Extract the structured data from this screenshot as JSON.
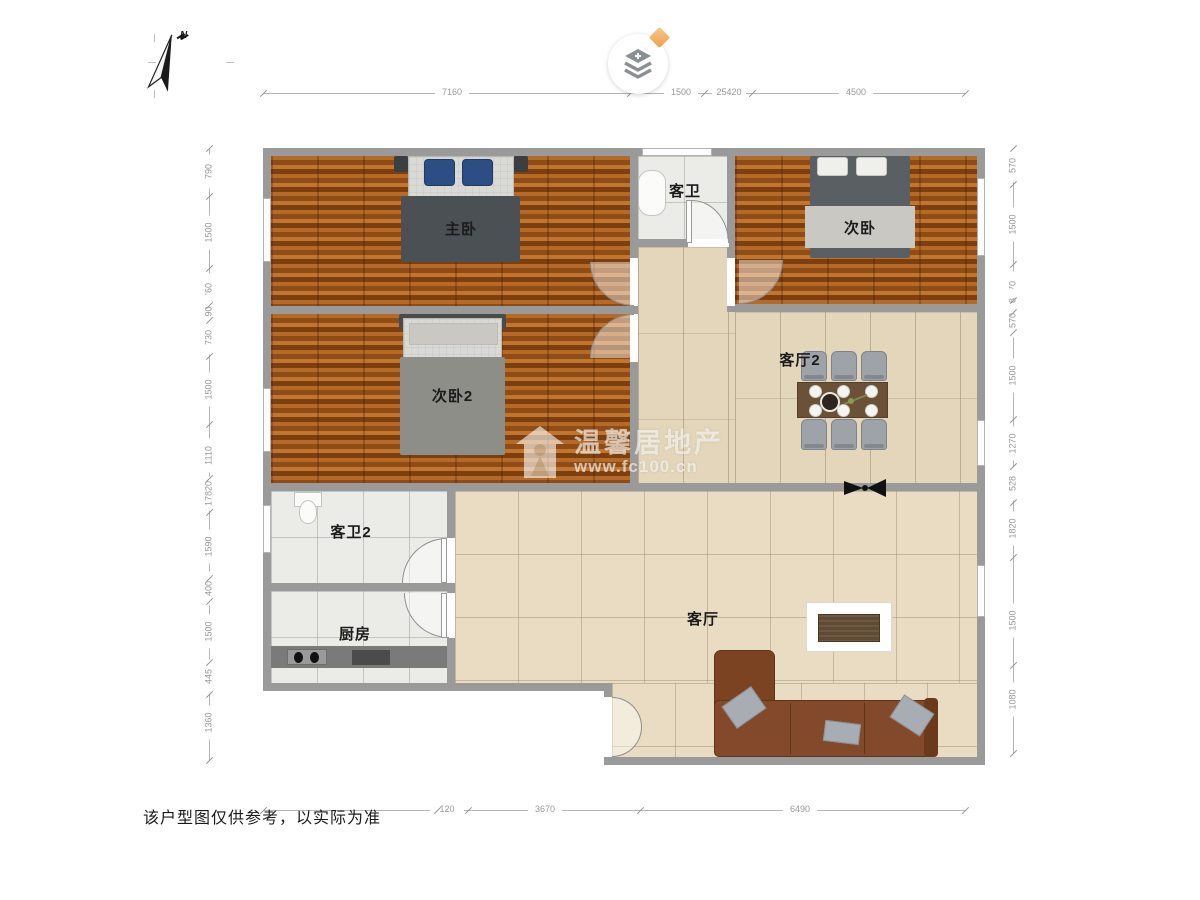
{
  "page": {
    "disclaimer": "该户型图仅供参考，以实际为准"
  },
  "watermark": {
    "brand": "温馨居地产",
    "url": "www.fc100.cn",
    "icon": "house-person-icon"
  },
  "compass": {
    "label": "N",
    "icon": "north-arrow-icon"
  },
  "logo": {
    "icon": "layers-plus-icon",
    "badge_icon": "diamond-icon",
    "badge_color": "#eda04b"
  },
  "colors": {
    "wall": "#9a9a9a",
    "wood_floor": "#9c5517",
    "tile_dining": "#e3d6ba",
    "tile_living": "#e9dcc2",
    "tile_bath": "#ebebe8",
    "sofa": "#7c4322",
    "dining_table": "#6a5138",
    "pillow_blue": "#2d4d85",
    "blanket_dark": "#4b5055"
  },
  "rooms": [
    {
      "id": "master-bedroom",
      "label": "主卧"
    },
    {
      "id": "bedroom2",
      "label": "次卧2"
    },
    {
      "id": "bedroom",
      "label": "次卧"
    },
    {
      "id": "bathroom",
      "label": "客卫"
    },
    {
      "id": "dining-hall",
      "label": "客厅2"
    },
    {
      "id": "bathroom2",
      "label": "客卫2"
    },
    {
      "id": "kitchen",
      "label": "厨房"
    },
    {
      "id": "living-room",
      "label": "客厅"
    }
  ],
  "furniture": {
    "master_bed": "double-bed-icon",
    "bedroom2_bed": "double-bed-icon",
    "bedroom_bed": "double-bed-icon",
    "dining_table": "dining-table-icon",
    "dining_chairs": "chair-icon",
    "sofa": "sectional-sofa-icon",
    "tv_cabinet": "tv-cabinet-icon",
    "bathtub": "bathtub-icon",
    "toilet": "toilet-icon",
    "kitchen_counter": "kitchen-counter-icon",
    "sink": "double-sink-icon",
    "vent": "ceiling-fan-icon"
  },
  "dimensions": {
    "top": {
      "labels": [
        {
          "t": "7160",
          "p": 452
        },
        {
          "t": "1500",
          "p": 681
        },
        {
          "t": "25420",
          "p": 729
        },
        {
          "t": "4500",
          "p": 856
        }
      ],
      "ticks": [
        263,
        630,
        704,
        752,
        965
      ]
    },
    "bottom": {
      "labels": [
        {
          "t": "120",
          "p": 447
        },
        {
          "t": "3670",
          "p": 545
        },
        {
          "t": "6490",
          "p": 800
        }
      ],
      "ticks": [
        263,
        437,
        468,
        640,
        965
      ]
    },
    "left": {
      "labels": [
        {
          "t": "790",
          "p": 172
        },
        {
          "t": "1500",
          "p": 233
        },
        {
          "t": "760",
          "p": 291
        },
        {
          "t": "90",
          "p": 312
        },
        {
          "t": "730",
          "p": 338
        },
        {
          "t": "1500",
          "p": 390
        },
        {
          "t": "1110",
          "p": 456
        },
        {
          "t": "17820",
          "p": 494
        },
        {
          "t": "1590",
          "p": 547
        },
        {
          "t": "400",
          "p": 589
        },
        {
          "t": "1500",
          "p": 632
        },
        {
          "t": "445",
          "p": 677
        },
        {
          "t": "1360",
          "p": 723
        }
      ],
      "ticks": [
        148,
        196,
        268,
        305,
        320,
        356,
        424,
        478,
        512,
        578,
        601,
        662,
        694,
        760
      ]
    },
    "right": {
      "labels": [
        {
          "t": "570",
          "p": 166
        },
        {
          "t": "1500",
          "p": 225
        },
        {
          "t": "970",
          "p": 289
        },
        {
          "t": "128",
          "p": 306
        },
        {
          "t": "570",
          "p": 321
        },
        {
          "t": "1500",
          "p": 376
        },
        {
          "t": "1270",
          "p": 444
        },
        {
          "t": "528",
          "p": 484
        },
        {
          "t": "1820",
          "p": 529
        },
        {
          "t": "1500",
          "p": 621
        },
        {
          "t": "1080",
          "p": 700
        }
      ],
      "ticks": [
        148,
        184,
        264,
        300,
        312,
        332,
        419,
        466,
        502,
        557,
        665,
        753
      ]
    }
  }
}
